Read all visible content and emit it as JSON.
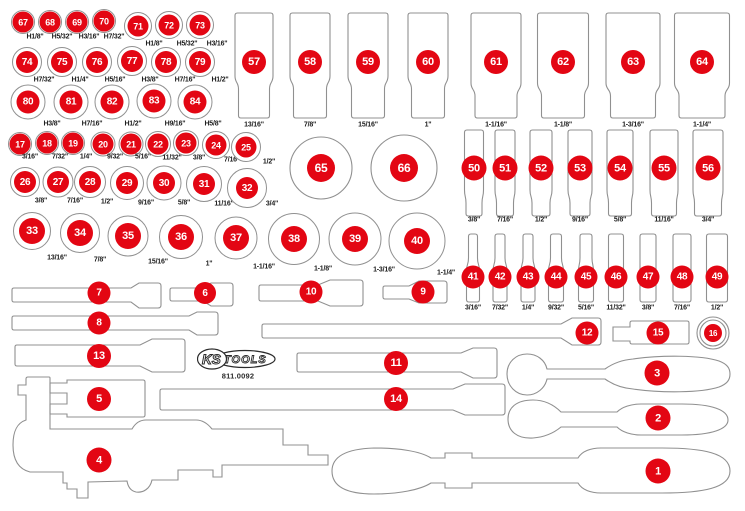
{
  "part_label": {
    "logo_ks": "KS",
    "logo_tools": "TOOLS",
    "part_number": "811.0092"
  },
  "colors": {
    "badge_red": "#e30613",
    "outline_gray": "#909090",
    "label_text": "#1c1c1c",
    "background": "#ffffff"
  },
  "circle_groups": [
    {
      "name": "hex-keys-top",
      "items": [
        {
          "n": "67",
          "size": "H1/8\"",
          "cx": 23,
          "cy": 22,
          "ring": 12,
          "badge": 10.5,
          "lx": 35,
          "ly": 37
        },
        {
          "n": "68",
          "size": "H5/32\"",
          "cx": 50,
          "cy": 22,
          "ring": 12,
          "badge": 10.5,
          "lx": 62,
          "ly": 37
        },
        {
          "n": "69",
          "size": "H3/16\"",
          "cx": 77,
          "cy": 22,
          "ring": 12,
          "badge": 10.5,
          "lx": 89,
          "ly": 37
        },
        {
          "n": "70",
          "size": "H7/32\"",
          "cx": 104,
          "cy": 21,
          "ring": 12,
          "badge": 10.5,
          "lx": 114,
          "ly": 37
        },
        {
          "n": "71",
          "size": "H1/8\"",
          "cx": 138,
          "cy": 26,
          "ring": 14,
          "badge": 10.5,
          "lx": 154,
          "ly": 44
        },
        {
          "n": "72",
          "size": "H5/32\"",
          "cx": 169,
          "cy": 25,
          "ring": 14,
          "badge": 10.5,
          "lx": 187,
          "ly": 44
        },
        {
          "n": "73",
          "size": "H3/16\"",
          "cx": 200,
          "cy": 25,
          "ring": 14,
          "badge": 10.5,
          "lx": 217,
          "ly": 44
        }
      ]
    },
    {
      "name": "hex-keys-mid",
      "items": [
        {
          "n": "74",
          "size": "H7/32\"",
          "cx": 27,
          "cy": 62,
          "ring": 15,
          "badge": 11,
          "lx": 44,
          "ly": 80
        },
        {
          "n": "75",
          "size": "H1/4\"",
          "cx": 62,
          "cy": 62,
          "ring": 15,
          "badge": 11,
          "lx": 80,
          "ly": 80
        },
        {
          "n": "76",
          "size": "H5/16\"",
          "cx": 97,
          "cy": 62,
          "ring": 15,
          "badge": 11,
          "lx": 115,
          "ly": 80
        },
        {
          "n": "77",
          "size": "H3/8\"",
          "cx": 132,
          "cy": 61,
          "ring": 15,
          "badge": 11,
          "lx": 150,
          "ly": 80
        },
        {
          "n": "78",
          "size": "H7/16\"",
          "cx": 166,
          "cy": 62,
          "ring": 15,
          "badge": 11,
          "lx": 185,
          "ly": 80
        },
        {
          "n": "79",
          "size": "H1/2\"",
          "cx": 200,
          "cy": 62,
          "ring": 15,
          "badge": 11,
          "lx": 220,
          "ly": 80
        }
      ]
    },
    {
      "name": "hex-keys-bottom",
      "items": [
        {
          "n": "80",
          "size": "H3/8\"",
          "cx": 28,
          "cy": 102,
          "ring": 17.5,
          "badge": 11.5,
          "lx": 52,
          "ly": 124
        },
        {
          "n": "81",
          "size": "H7/16\"",
          "cx": 71,
          "cy": 102,
          "ring": 17.5,
          "badge": 11.5,
          "lx": 92,
          "ly": 124
        },
        {
          "n": "82",
          "size": "H1/2\"",
          "cx": 112,
          "cy": 102,
          "ring": 17.5,
          "badge": 11.5,
          "lx": 133,
          "ly": 124
        },
        {
          "n": "83",
          "size": "H9/16\"",
          "cx": 154,
          "cy": 101,
          "ring": 17.5,
          "badge": 11.5,
          "lx": 175,
          "ly": 124
        },
        {
          "n": "84",
          "size": "H5/8\"",
          "cx": 195,
          "cy": 102,
          "ring": 17.5,
          "badge": 11.5,
          "lx": 213,
          "ly": 124
        }
      ]
    },
    {
      "name": "sae-row-small",
      "items": [
        {
          "n": "17",
          "size": "3/16\"",
          "cx": 20,
          "cy": 144,
          "ring": 12,
          "badge": 10.5,
          "lx": 30,
          "ly": 157
        },
        {
          "n": "18",
          "size": "7/32\"",
          "cx": 47,
          "cy": 143,
          "ring": 12,
          "badge": 10.5,
          "lx": 60,
          "ly": 157
        },
        {
          "n": "19",
          "size": "1/4\"",
          "cx": 73,
          "cy": 143,
          "ring": 12,
          "badge": 10.5,
          "lx": 86,
          "ly": 157
        },
        {
          "n": "20",
          "size": "9/32\"",
          "cx": 103,
          "cy": 144,
          "ring": 12.5,
          "badge": 10.5,
          "lx": 115,
          "ly": 157
        },
        {
          "n": "21",
          "size": "5/16\"",
          "cx": 131,
          "cy": 144,
          "ring": 12.5,
          "badge": 10.5,
          "lx": 143,
          "ly": 157
        },
        {
          "n": "22",
          "size": "11/32\"",
          "cx": 158,
          "cy": 144,
          "ring": 13,
          "badge": 10.5,
          "lx": 172,
          "ly": 158
        },
        {
          "n": "23",
          "size": "3/8\"",
          "cx": 186,
          "cy": 143,
          "ring": 13,
          "badge": 10.5,
          "lx": 199,
          "ly": 158
        },
        {
          "n": "24",
          "size": "7/16\"",
          "cx": 216,
          "cy": 145,
          "ring": 14,
          "badge": 10.5,
          "lx": 232,
          "ly": 160
        },
        {
          "n": "25",
          "size": "1/2\"",
          "cx": 246,
          "cy": 147,
          "ring": 15,
          "badge": 10.5,
          "lx": 269,
          "ly": 162
        }
      ]
    },
    {
      "name": "sae-row-mid",
      "items": [
        {
          "n": "26",
          "size": "3/8\"",
          "cx": 25,
          "cy": 182,
          "ring": 15,
          "badge": 11,
          "lx": 41,
          "ly": 201
        },
        {
          "n": "27",
          "size": "7/16\"",
          "cx": 58,
          "cy": 182,
          "ring": 15.5,
          "badge": 11,
          "lx": 75,
          "ly": 201
        },
        {
          "n": "28",
          "size": "1/2\"",
          "cx": 90,
          "cy": 182,
          "ring": 16,
          "badge": 11,
          "lx": 107,
          "ly": 202
        },
        {
          "n": "29",
          "size": "9/16\"",
          "cx": 127,
          "cy": 183,
          "ring": 17,
          "badge": 11,
          "lx": 146,
          "ly": 203
        },
        {
          "n": "30",
          "size": "5/8\"",
          "cx": 164,
          "cy": 183,
          "ring": 17.5,
          "badge": 11,
          "lx": 184,
          "ly": 203
        },
        {
          "n": "31",
          "size": "11/16\"",
          "cx": 204,
          "cy": 184,
          "ring": 18,
          "badge": 11,
          "lx": 224,
          "ly": 204
        },
        {
          "n": "32",
          "size": "3/4\"",
          "cx": 247,
          "cy": 188,
          "ring": 20,
          "badge": 11,
          "lx": 272,
          "ly": 204
        }
      ]
    },
    {
      "name": "sae-row-large",
      "items": [
        {
          "n": "33",
          "size": "13/16\"",
          "cx": 32,
          "cy": 231,
          "ring": 19,
          "badge": 13,
          "lx": 57,
          "ly": 258
        },
        {
          "n": "34",
          "size": "7/8\"",
          "cx": 80,
          "cy": 233,
          "ring": 20,
          "badge": 13,
          "lx": 100,
          "ly": 260
        },
        {
          "n": "35",
          "size": "15/16\"",
          "cx": 128,
          "cy": 236,
          "ring": 20.5,
          "badge": 13,
          "lx": 158,
          "ly": 262
        },
        {
          "n": "36",
          "size": "1\"",
          "cx": 181,
          "cy": 237,
          "ring": 22,
          "badge": 13,
          "lx": 209,
          "ly": 264
        },
        {
          "n": "37",
          "size": "1-1/16\"",
          "cx": 236,
          "cy": 238,
          "ring": 21.5,
          "badge": 13,
          "lx": 264,
          "ly": 267
        },
        {
          "n": "38",
          "size": "1-1/8\"",
          "cx": 294,
          "cy": 239,
          "ring": 26,
          "badge": 13,
          "lx": 323,
          "ly": 269
        },
        {
          "n": "39",
          "size": "1-3/16\"",
          "cx": 355,
          "cy": 239,
          "ring": 26.5,
          "badge": 13,
          "lx": 384,
          "ly": 270
        },
        {
          "n": "40",
          "size": "1-1/4\"",
          "cx": 417,
          "cy": 241,
          "ring": 28.5,
          "badge": 13,
          "lx": 446,
          "ly": 273
        }
      ]
    }
  ],
  "large_circles": [
    {
      "n": "65",
      "cx": 321,
      "cy": 168,
      "r": 31,
      "badge": 14
    },
    {
      "n": "66",
      "cx": 404,
      "cy": 168,
      "r": 33,
      "badge": 14
    }
  ],
  "socket_groups": [
    {
      "name": "deep-sockets",
      "top": 13,
      "bottom": 118,
      "waist": 76,
      "label_y": 125,
      "badge_y": 62,
      "badge_r": 12,
      "items": [
        {
          "n": "57",
          "size": "13/16\"",
          "cx": 254,
          "top_w": 38,
          "bot_w": 31,
          "waist": 76
        },
        {
          "n": "58",
          "size": "7/8\"",
          "cx": 310,
          "top_w": 40,
          "bot_w": 33,
          "waist": 76
        },
        {
          "n": "59",
          "size": "15/16\"",
          "cx": 368,
          "top_w": 40,
          "bot_w": 33,
          "waist": 76
        },
        {
          "n": "60",
          "size": "1\"",
          "cx": 428,
          "top_w": 40,
          "bot_w": 33,
          "waist": 76
        },
        {
          "n": "61",
          "size": "1-1/16\"",
          "cx": 496,
          "top_w": 50,
          "bot_w": 42,
          "waist": 83
        },
        {
          "n": "62",
          "size": "1-1/8\"",
          "cx": 563,
          "top_w": 51,
          "bot_w": 43,
          "waist": 83
        },
        {
          "n": "63",
          "size": "1-3/16\"",
          "cx": 633,
          "top_w": 54,
          "bot_w": 45,
          "waist": 83
        },
        {
          "n": "64",
          "size": "1-1/4\"",
          "cx": 702,
          "top_w": 55,
          "bot_w": 46,
          "waist": 83
        }
      ]
    },
    {
      "name": "mid-sockets",
      "top": 130,
      "bottom": 216,
      "waist": 190,
      "label_y": 220,
      "badge_y": 168,
      "badge_r": 12.5,
      "items": [
        {
          "n": "50",
          "size": "3/8\"",
          "cx": 474,
          "top_w": 19,
          "bot_w": 16
        },
        {
          "n": "51",
          "size": "7/16\"",
          "cx": 505,
          "top_w": 20,
          "bot_w": 17
        },
        {
          "n": "52",
          "size": "1/2\"",
          "cx": 541,
          "top_w": 22,
          "bot_w": 18
        },
        {
          "n": "53",
          "size": "9/16\"",
          "cx": 580,
          "top_w": 24,
          "bot_w": 20
        },
        {
          "n": "54",
          "size": "5/8\"",
          "cx": 620,
          "top_w": 26,
          "bot_w": 23
        },
        {
          "n": "55",
          "size": "11/16\"",
          "cx": 664,
          "top_w": 28,
          "bot_w": 25
        },
        {
          "n": "56",
          "size": "3/4\"",
          "cx": 708,
          "top_w": 30,
          "bot_w": 27
        }
      ]
    },
    {
      "name": "small-sockets",
      "top": 234,
      "bottom": 302,
      "waist": 258,
      "label_y": 308,
      "badge_y": 277,
      "badge_r": 11.5,
      "items": [
        {
          "n": "41",
          "size": "3/16\"",
          "cx": 473,
          "top_w": 9,
          "bot_w": 13
        },
        {
          "n": "42",
          "size": "7/32\"",
          "cx": 500,
          "top_w": 10,
          "bot_w": 14
        },
        {
          "n": "43",
          "size": "1/4\"",
          "cx": 528,
          "top_w": 10,
          "bot_w": 14
        },
        {
          "n": "44",
          "size": "9/32\"",
          "cx": 556,
          "top_w": 11,
          "bot_w": 15
        },
        {
          "n": "45",
          "size": "5/16\"",
          "cx": 586,
          "top_w": 12,
          "bot_w": 15
        },
        {
          "n": "46",
          "size": "11/32\"",
          "cx": 616,
          "top_w": 15,
          "bot_w": 15
        },
        {
          "n": "47",
          "size": "3/8\"",
          "cx": 648,
          "top_w": 16,
          "bot_w": 16
        },
        {
          "n": "48",
          "size": "7/16\"",
          "cx": 682,
          "top_w": 18,
          "bot_w": 18
        },
        {
          "n": "49",
          "size": "1/2\"",
          "cx": 717,
          "top_w": 21,
          "bot_w": 21
        }
      ]
    }
  ],
  "tools": [
    {
      "n": "1",
      "bx": 658,
      "by": 471,
      "r": 12.5
    },
    {
      "n": "2",
      "bx": 658,
      "by": 418,
      "r": 12.5
    },
    {
      "n": "3",
      "bx": 657,
      "by": 373,
      "r": 12.5
    },
    {
      "n": "4",
      "bx": 99,
      "by": 460,
      "r": 12.5
    },
    {
      "n": "5",
      "bx": 99,
      "by": 399,
      "r": 12
    },
    {
      "n": "6",
      "bx": 205,
      "by": 293,
      "r": 11
    },
    {
      "n": "7",
      "bx": 99,
      "by": 293,
      "r": 11.5
    },
    {
      "n": "8",
      "bx": 99,
      "by": 323,
      "r": 11.5
    },
    {
      "n": "9",
      "bx": 423,
      "by": 292,
      "r": 11.5
    },
    {
      "n": "10",
      "bx": 311,
      "by": 292,
      "r": 11.5
    },
    {
      "n": "11",
      "bx": 396,
      "by": 363,
      "r": 12
    },
    {
      "n": "12",
      "bx": 587,
      "by": 333,
      "r": 11.5
    },
    {
      "n": "13",
      "bx": 99,
      "by": 356,
      "r": 12
    },
    {
      "n": "14",
      "bx": 396,
      "by": 399,
      "r": 12
    },
    {
      "n": "15",
      "bx": 658,
      "by": 333,
      "r": 11.5
    },
    {
      "n": "16",
      "bx": 713,
      "by": 333,
      "r": 9
    }
  ]
}
